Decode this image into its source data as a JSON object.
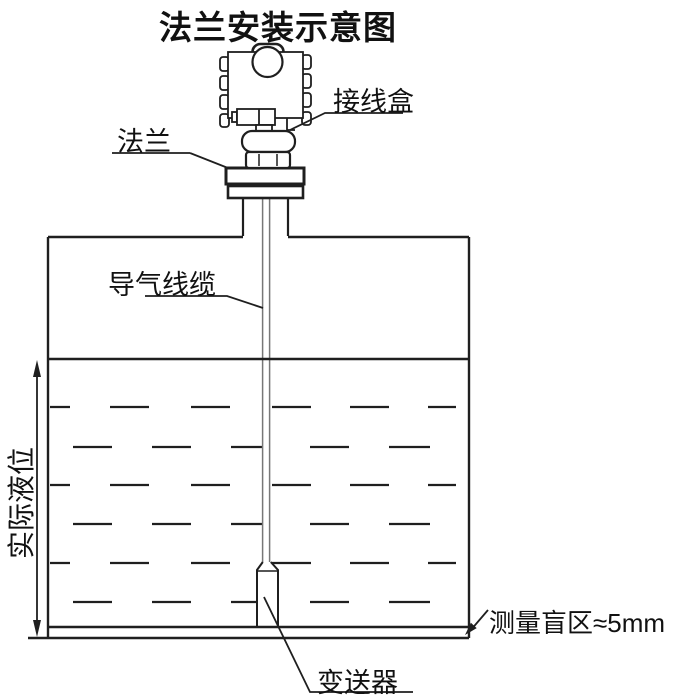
{
  "title": "法兰安装示意图",
  "labels": {
    "junction_box": "接线盒",
    "flange": "法兰",
    "air_guide_cable": "导气线缆",
    "actual_liquid_level": "实际液位",
    "transmitter": "变送器",
    "blind_zone": "测量盲区≈5mm"
  },
  "colors": {
    "line": "#1f1f1f",
    "stem": "#777777",
    "background": "#ffffff"
  }
}
